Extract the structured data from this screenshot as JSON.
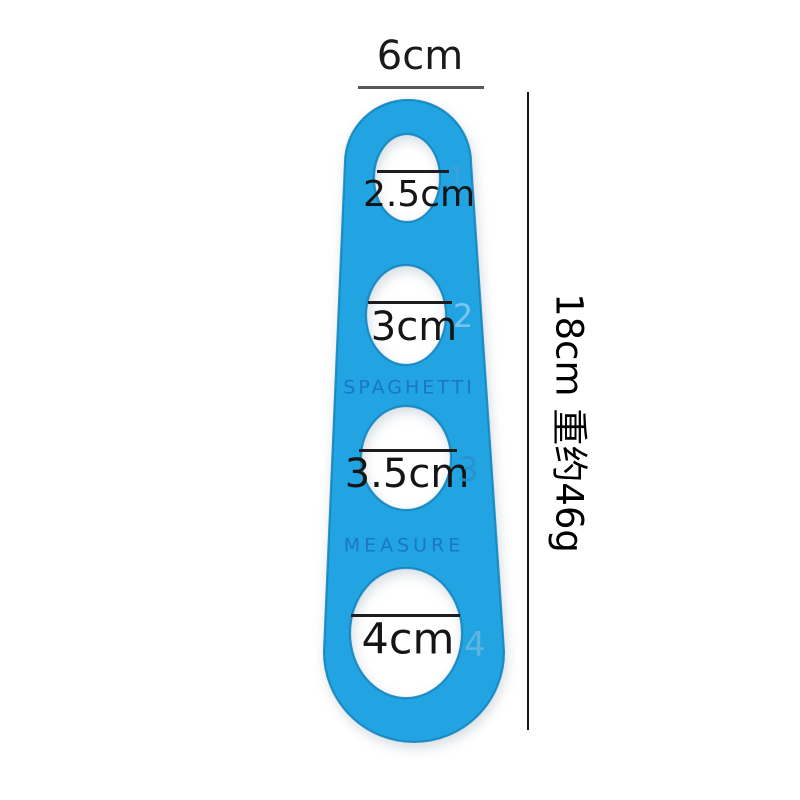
{
  "scene": {
    "background_color": "#ffffff"
  },
  "dimensions": {
    "width": {
      "label": "6cm"
    },
    "length": {
      "label": "18cm 重约46g"
    }
  },
  "tool": {
    "body_color": "#22a3e2",
    "edge_color": "#1182bd",
    "engraving_color": "#1b76c2",
    "type_label": "SPAGHETTI",
    "function_label": "MEASURE",
    "holes": [
      {
        "number": "1",
        "diameter": "2.5cm"
      },
      {
        "number": "2",
        "diameter": "3cm"
      },
      {
        "number": "3",
        "diameter": "3.5cm"
      },
      {
        "number": "4",
        "diameter": "4cm"
      }
    ]
  }
}
